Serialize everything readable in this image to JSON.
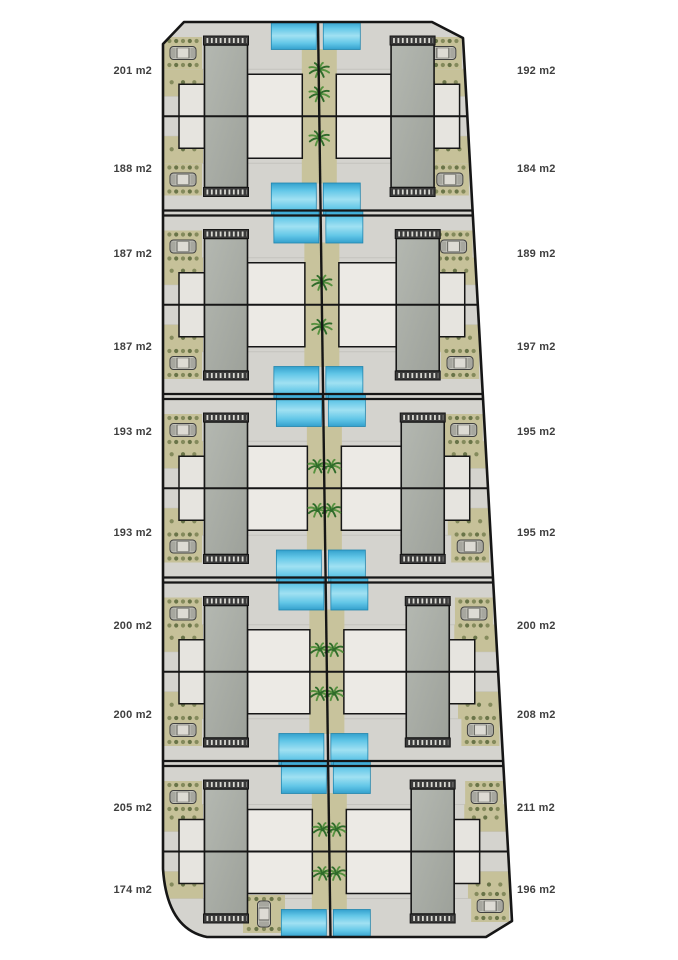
{
  "page": {
    "background": "#ffffff"
  },
  "site_plan": {
    "description": "Residential site plan, 5 blocks of back-to-back paired villas with pools and palm garden strip",
    "blocks_count": 5,
    "units_count": 20,
    "area_unit": "m2",
    "unit_rows": [
      {
        "row": 1,
        "left_area": "201 m2",
        "right_area": "192 m2"
      },
      {
        "row": 2,
        "left_area": "188 m2",
        "right_area": "184 m2"
      },
      {
        "row": 3,
        "left_area": "187 m2",
        "right_area": "189 m2"
      },
      {
        "row": 4,
        "left_area": "187 m2",
        "right_area": "197 m2"
      },
      {
        "row": 5,
        "left_area": "193 m2",
        "right_area": "195 m2"
      },
      {
        "row": 6,
        "left_area": "193 m2",
        "right_area": "195 m2"
      },
      {
        "row": 7,
        "left_area": "200 m2",
        "right_area": "200 m2"
      },
      {
        "row": 8,
        "left_area": "200 m2",
        "right_area": "208 m2"
      },
      {
        "row": 9,
        "left_area": "205 m2",
        "right_area": "211 m2"
      },
      {
        "row": 10,
        "left_area": "174 m2",
        "right_area": "196 m2"
      }
    ],
    "icons": {
      "palm": "palm-tree-icon",
      "car": "car-icon"
    },
    "colors": {
      "ground": "#d4d3ce",
      "outline": "#161616",
      "roof": "#a9ada6",
      "roof_light": "#b4b8b1",
      "roof_dark_strip": "#3a3a3a",
      "hatch_tick": "#d8d8d2",
      "patio": "#eceae5",
      "patio_small": "#e6e4df",
      "pool_dark": "#2f9fce",
      "pool_mid": "#5ec6e8",
      "pool_light": "#9fe2f4",
      "landscape": "#c6c199",
      "garden_strip": "#c8c39c",
      "tuft_dark": "#5e6b3f",
      "tuft_light": "#7c8455",
      "palm_dark": "#2f6b2a",
      "palm_light": "#56923f",
      "car_body": "#c2c2ba",
      "car_roof": "#dddbd4",
      "car_detail": "#3f3f3f",
      "seam": "#c2c1bc",
      "label_text": "#3f3f3f"
    }
  }
}
